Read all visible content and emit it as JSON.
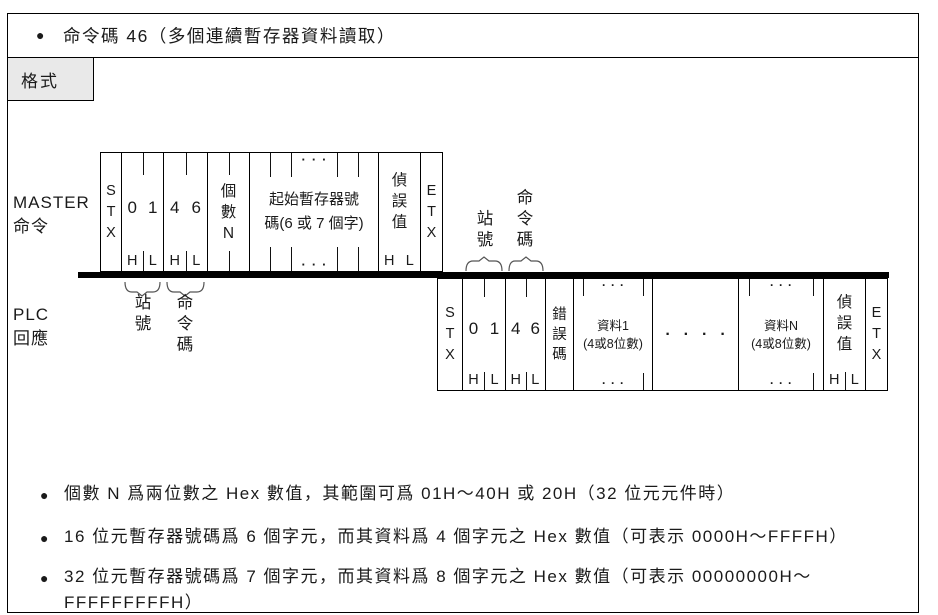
{
  "header": {
    "bullet": "●",
    "title": "命令碼 46（多個連續暫存器資料讀取）"
  },
  "tab": {
    "label": "格式"
  },
  "diagram": {
    "master_label": "MASTER\n命令",
    "plc_label": "PLC\n回應",
    "sym": {
      "stx": "STX",
      "etx": "ETX",
      "h": "H",
      "l": "L",
      "d0": "0",
      "d1": "1",
      "d4": "4",
      "d6": "6",
      "dots3": "···",
      "dots4": "····"
    },
    "master": {
      "count": "個數N",
      "start_reg": "起始暫存器號\n碼(6 或 7 個字)",
      "check": "偵誤值"
    },
    "plc": {
      "error": "錯誤碼",
      "data1": "資料1\n(4或8位數)",
      "dataN": "資料N\n(4或8位數)",
      "check": "偵誤值"
    },
    "annotations": {
      "station": "站號",
      "command": "命令碼"
    }
  },
  "notes": [
    {
      "bullet": "●",
      "text": "個數 N 爲兩位數之 Hex 數值，其範圍可爲 01H～40H 或 20H（32 位元元件時）"
    },
    {
      "bullet": "●",
      "text": "16 位元暫存器號碼爲 6 個字元，而其資料爲 4 個字元之 Hex 數值（可表示 0000H～FFFFH）"
    },
    {
      "bullet": "●",
      "text": "32 位元暫存器號碼爲 7 個字元，而其資料爲 8 個字元之 Hex 數值（可表示 00000000H～\nFFFFFFFFFH）"
    }
  ],
  "colors": {
    "line": "#000000",
    "text": "#1a1a1a",
    "tab_bg": "#e9e9e9"
  }
}
